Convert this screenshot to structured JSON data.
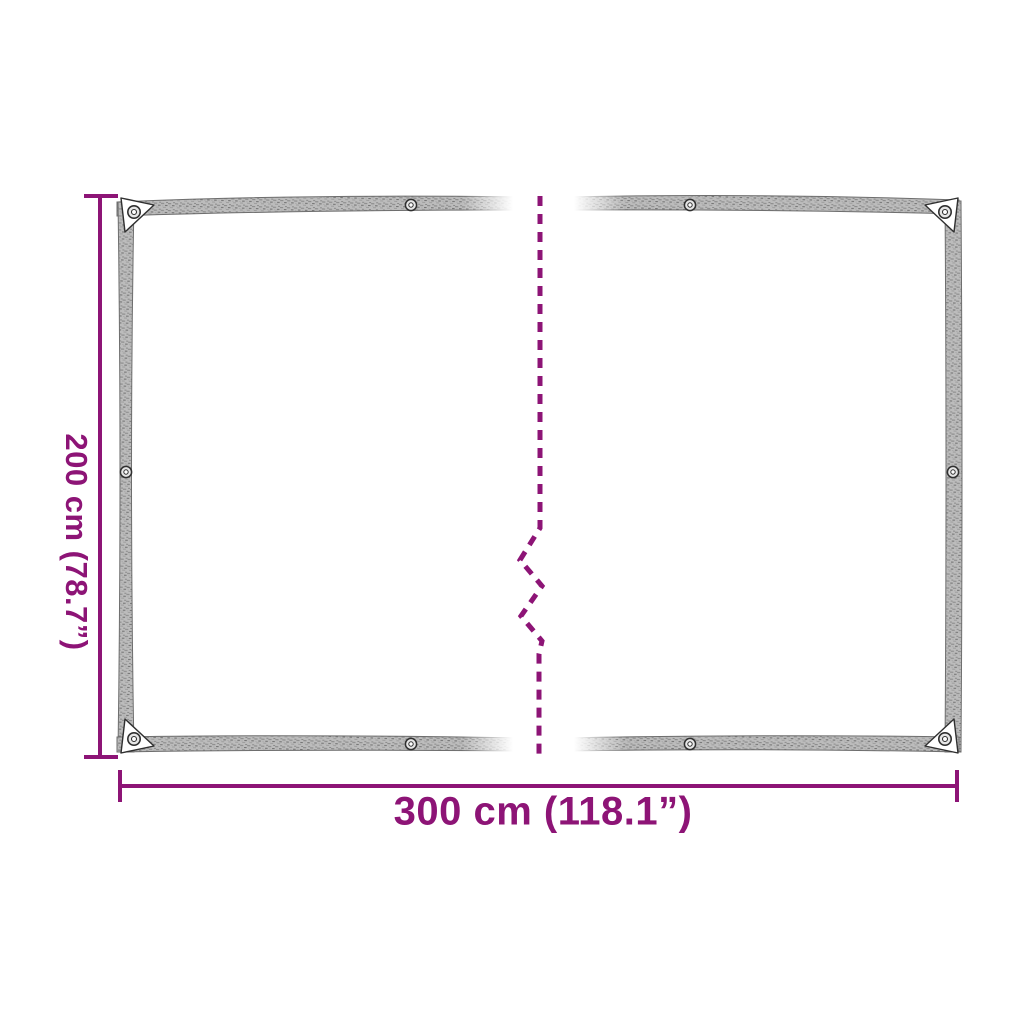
{
  "labels": {
    "height": "200 cm (78.7”)",
    "width": "300 cm (118.1”)"
  },
  "colors": {
    "accent": "#8D1476",
    "tarp_band_base": "#bcbcbc",
    "tarp_band_fleck": "#7d7d7d",
    "tarp_outline": "#6e6e6e",
    "background": "#ffffff"
  }
}
